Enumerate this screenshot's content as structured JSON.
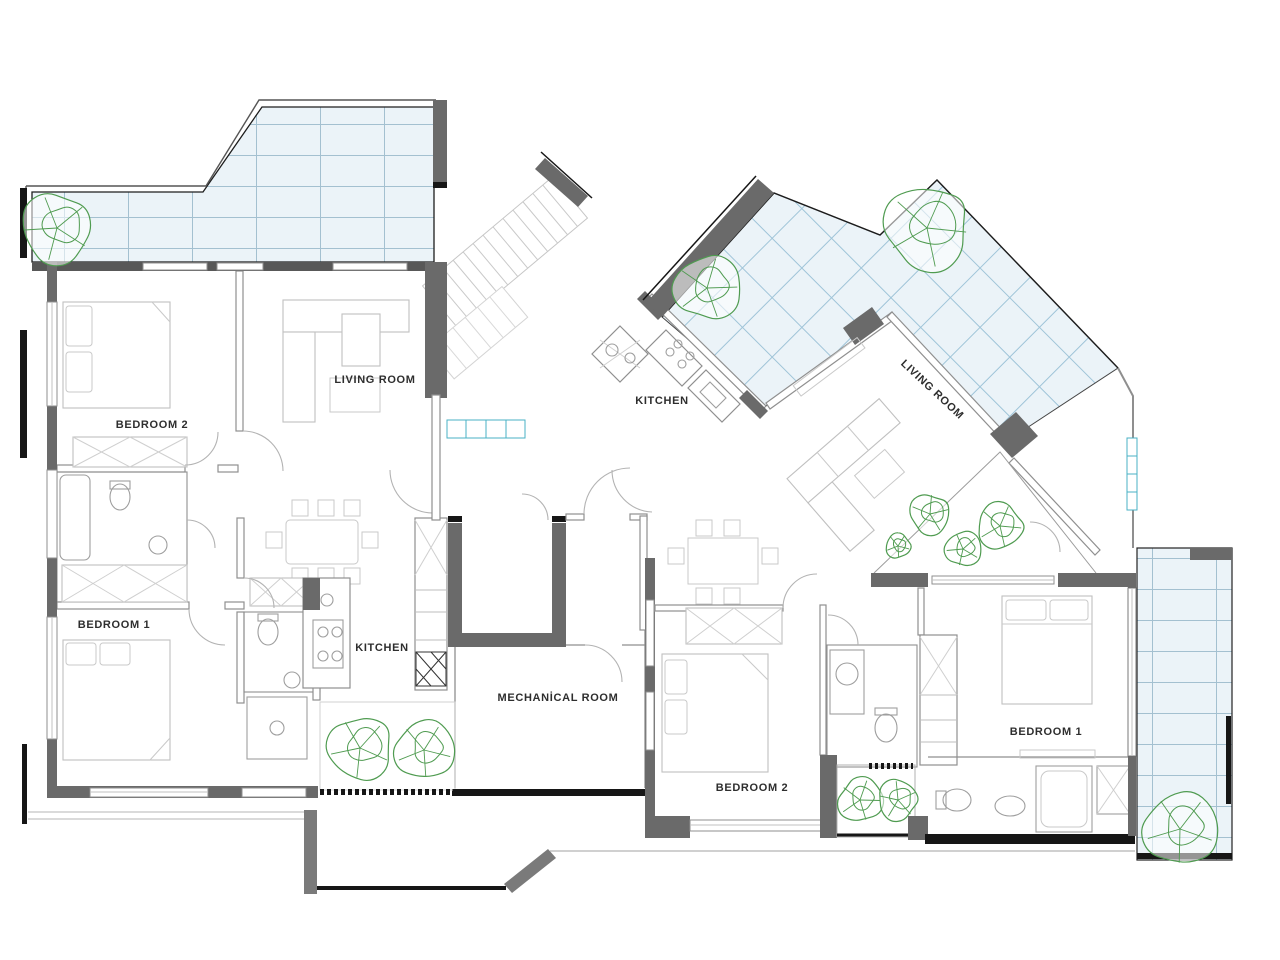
{
  "drawing_type": "architectural floor plan",
  "rooms": {
    "left": {
      "living_room": "LIVING ROOM",
      "bedroom_2": "BEDROOM 2",
      "bedroom_1": "BEDROOM 1",
      "kitchen": "KITCHEN"
    },
    "right": {
      "kitchen": "KITCHEN",
      "living_room": "LIVING ROOM",
      "bedroom_2": "BEDROOM 2",
      "bedroom_1": "BEDROOM 1"
    },
    "core": {
      "mechanical_room": "MECHANİCAL ROOM"
    }
  },
  "colors": {
    "wall_gray": "#6a6a6a",
    "accent_black": "#161616",
    "terrace_fill": "#ebf3f8",
    "terrace_grid": "#a3c0d0",
    "terrace_grid_diag": "#9fc4d8",
    "plant_green": "#4f9b50",
    "label_text": "#2e2e2e",
    "planter_teal": "#49b2c4"
  },
  "plants": [
    {
      "x": 57,
      "y": 228,
      "r": 40
    },
    {
      "x": 707,
      "y": 288,
      "r": 37
    },
    {
      "x": 927,
      "y": 228,
      "r": 48
    },
    {
      "x": 898,
      "y": 546,
      "r": 14
    },
    {
      "x": 930,
      "y": 514,
      "r": 23
    },
    {
      "x": 963,
      "y": 549,
      "r": 20
    },
    {
      "x": 1000,
      "y": 526,
      "r": 26
    },
    {
      "x": 360,
      "y": 748,
      "r": 36
    },
    {
      "x": 424,
      "y": 750,
      "r": 33
    },
    {
      "x": 860,
      "y": 800,
      "r": 25
    },
    {
      "x": 898,
      "y": 800,
      "r": 23
    },
    {
      "x": 1180,
      "y": 829,
      "r": 41
    }
  ]
}
